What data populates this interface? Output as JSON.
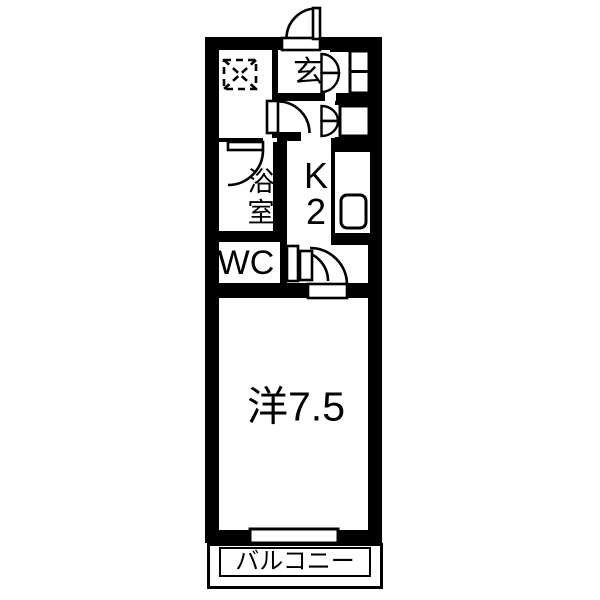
{
  "floorplan": {
    "type": "apartment-floor-plan-1K",
    "colors": {
      "wall": "#000000",
      "floor": "#ffffff",
      "background": "#ffffff"
    },
    "rooms": {
      "genkan": {
        "label": "玄"
      },
      "bathroom": {
        "label": "浴室"
      },
      "wc": {
        "label": "WC"
      },
      "kitchen": {
        "label": "K",
        "size": "2"
      },
      "main_room": {
        "label": "洋7.5"
      },
      "balcony": {
        "label": "バルコニー"
      }
    },
    "symbols": {
      "washer_space": "washing-machine-space-dashed-box",
      "entrance_door": "swing-door",
      "hall_door": "swing-door",
      "bathroom_door": "swing-door",
      "wc_door": "swing-door",
      "room_door": "swing-door",
      "closet_doors": "bifold-door",
      "sink": "kitchen-sink",
      "window": "sliding-window-to-balcony"
    }
  }
}
